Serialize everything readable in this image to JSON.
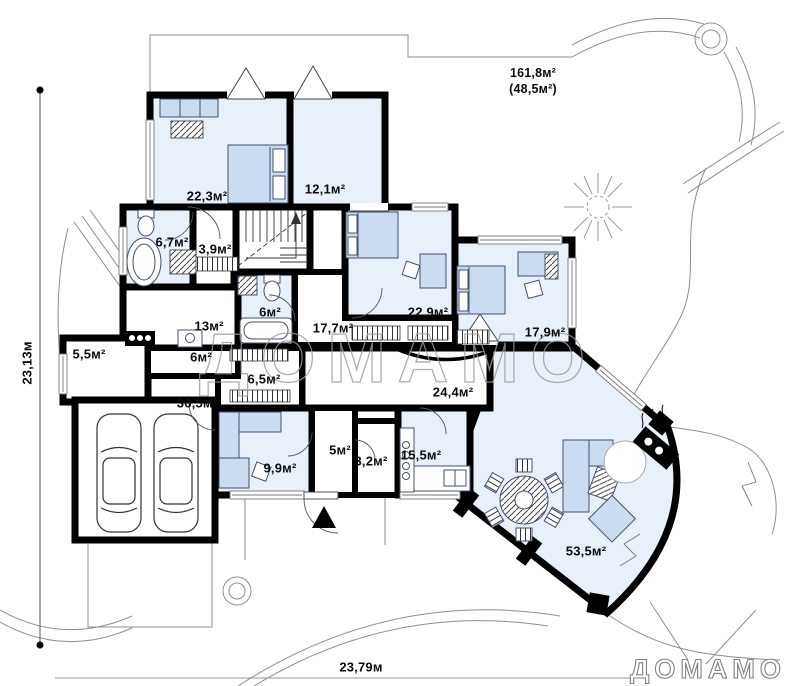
{
  "plan": {
    "brand": {
      "watermark": "ДОМАМО",
      "logo": "ДОМАМО"
    },
    "dimensions": {
      "left": "23,13м",
      "bottom": "23,79м"
    },
    "terrace": {
      "area": "161,8м²",
      "secondary": "(48,5м²)"
    },
    "rooms": {
      "bedroom_1": {
        "area": "22,3м²"
      },
      "hall_upper": {
        "area": "12,1м²"
      },
      "bathroom_1": {
        "area": "6,7м²"
      },
      "wardrobe": {
        "area": "3,9м²"
      },
      "bedroom_2": {
        "area": "22,9м²"
      },
      "corridor_upper": {
        "area": "17,7м²"
      },
      "bedroom_3": {
        "area": "17,9м²"
      },
      "kitchen_small": {
        "area": "13м²"
      },
      "bathroom_2": {
        "area": "6м²"
      },
      "pantry": {
        "area": "5,5м²"
      },
      "hall_small": {
        "area": "6м²"
      },
      "hall_mid": {
        "area": "6,5м²"
      },
      "garage": {
        "area": "36,5м²"
      },
      "corridor_lower": {
        "area": "24,4м²"
      },
      "vestibule": {
        "area": "5м²"
      },
      "office": {
        "area": "9,9м²"
      },
      "wc": {
        "area": "3,2м²"
      },
      "kitchen": {
        "area": "15,5м²"
      },
      "living_room": {
        "area": "53,5м²"
      }
    },
    "colors": {
      "room_fill": "#e8f0fa",
      "furniture_fill": "#ccdcf0",
      "wall": "#000000"
    }
  }
}
